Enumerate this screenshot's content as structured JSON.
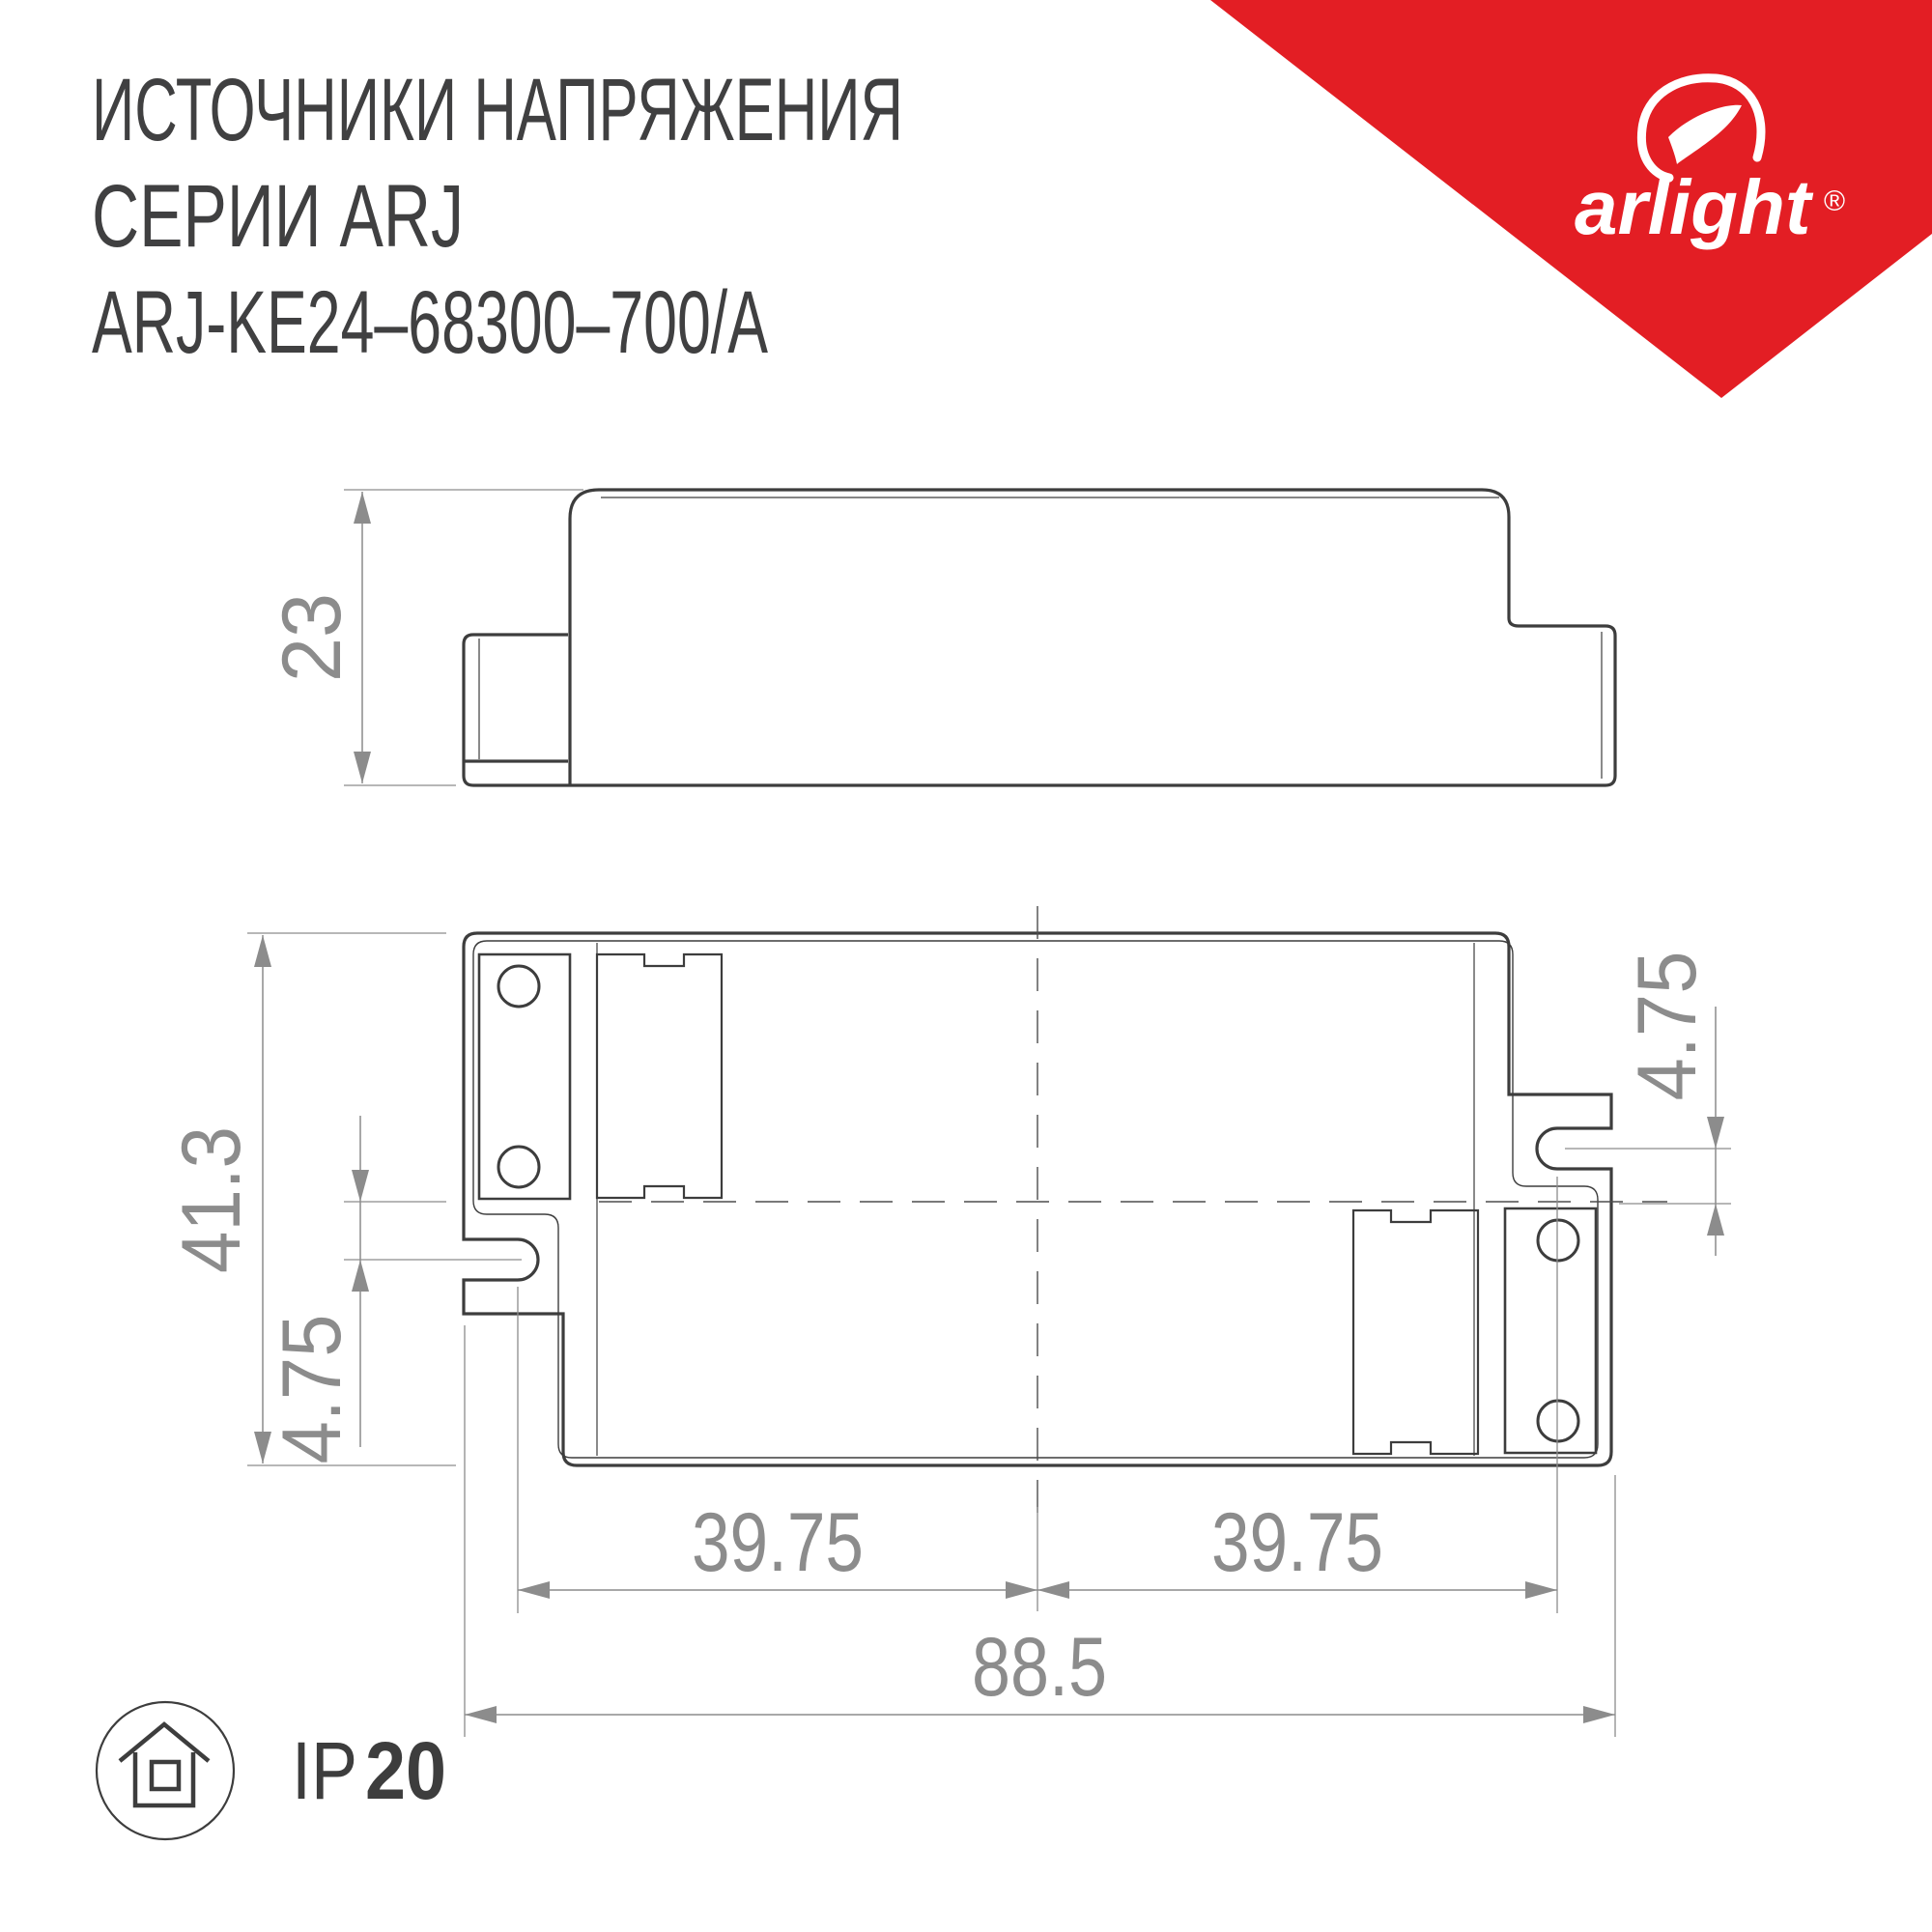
{
  "title": {
    "line1": "ИСТОЧНИКИ НАПРЯЖЕНИЯ",
    "line2": "СЕРИИ ARJ",
    "line3": "ARJ-KE24–68300–700/A"
  },
  "brand": {
    "name": "arlight",
    "registered_mark": "®",
    "triangle_color": "#e31e24"
  },
  "side_view": {
    "height_mm": "23"
  },
  "top_view": {
    "overall_length_mm": "88.5",
    "overall_width_mm": "41.3",
    "slot_spacing_left_mm": "39.75",
    "slot_spacing_right_mm": "39.75",
    "slot_offset_left_mm": "4.75",
    "slot_offset_right_mm": "4.75"
  },
  "footer": {
    "ip_prefix": "IP",
    "ip_value": "20"
  },
  "colors": {
    "line_dark": "#3d3d3d",
    "dimension_gray": "#8c8c8c",
    "title_text": "#404041",
    "brand_red": "#e31e24"
  }
}
